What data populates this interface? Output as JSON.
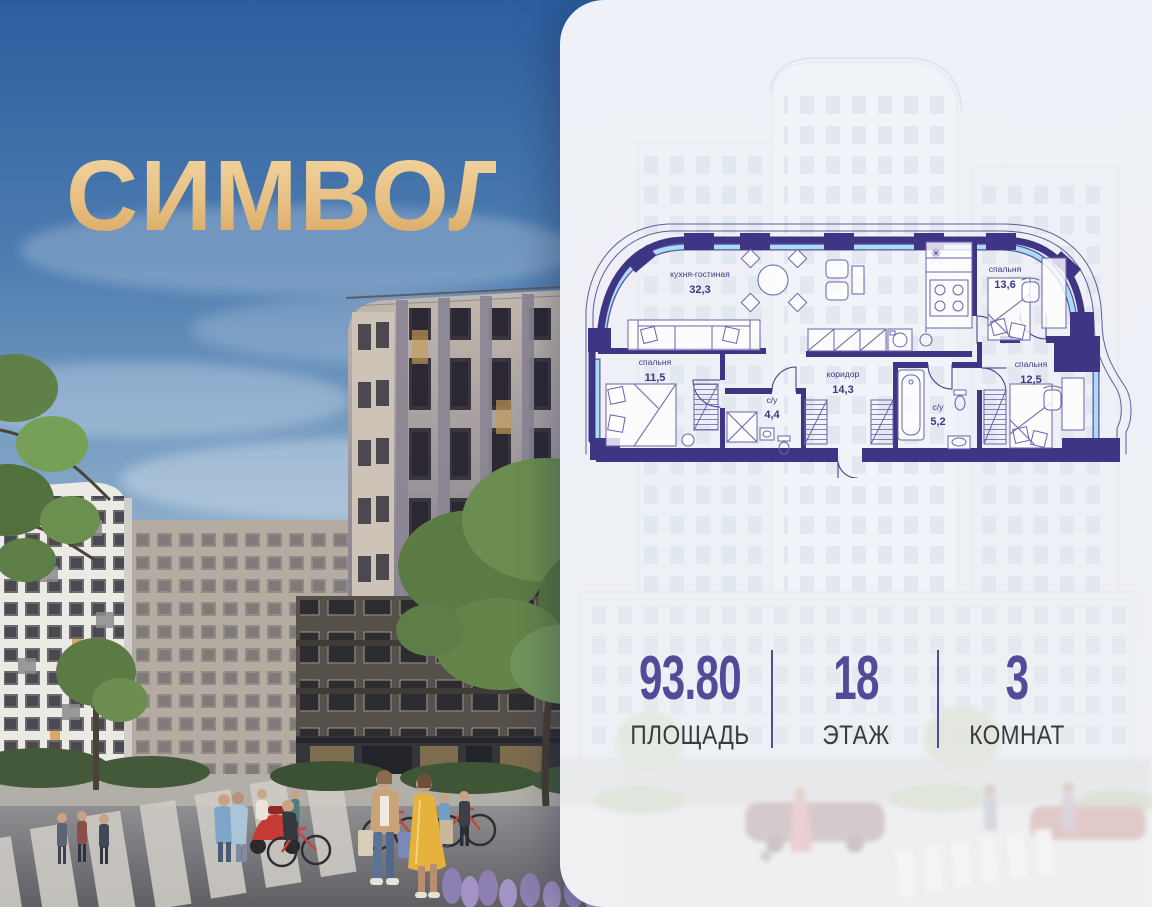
{
  "brand": {
    "logo_text": "СИМВОЛ",
    "gold_top": "#f2d49e",
    "gold_bottom": "#d8a55f"
  },
  "floorplan": {
    "wall_color": "#3e3585",
    "glazing_color": "#aadcf3",
    "rooms": [
      {
        "name": "кухня-гостиная",
        "area": "32,3"
      },
      {
        "name": "спальня",
        "area": "13,6"
      },
      {
        "name": "спальня",
        "area": "11,5"
      },
      {
        "name": "коридор",
        "area": "14,3"
      },
      {
        "name": "с/у",
        "area": "4,4"
      },
      {
        "name": "с/у",
        "area": "5,2"
      },
      {
        "name": "спальня",
        "area": "12,5"
      }
    ]
  },
  "stats": {
    "value_color": "#544a99",
    "label_color": "#3a3a3a",
    "items": [
      {
        "value": "93.80",
        "label": "ПЛОЩАДЬ"
      },
      {
        "value": "18",
        "label": "ЭТАЖ"
      },
      {
        "value": "3",
        "label": "КОМНАТ"
      }
    ]
  }
}
